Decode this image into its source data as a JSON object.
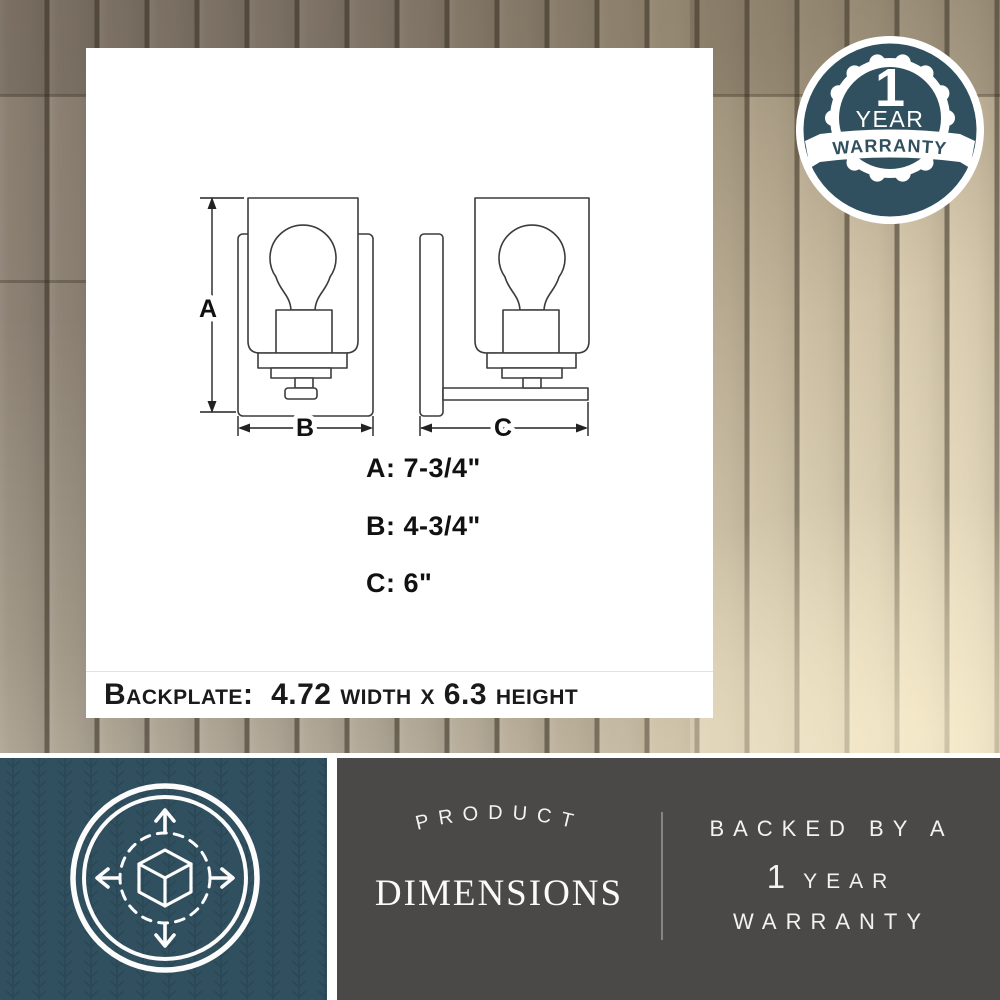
{
  "colors": {
    "teal": "#31505F",
    "teal_pattern": "#24404E",
    "footer_gray": "#4B4947",
    "wall_light": "#DDCFB2",
    "wall_dark": "#8C8173",
    "drawing_line": "#3c3c3c",
    "text_dark": "#1a1a1a",
    "white": "#ffffff"
  },
  "diagram": {
    "markers": [
      "A",
      "B",
      "C"
    ],
    "dim_rows": [
      "A: 7-3/4\"",
      "B: 4-3/4\"",
      "C: 6\""
    ],
    "backplate_note": "Backplate:  4.72 width x 6.3 height"
  },
  "badge": {
    "icon": "warranty-seal-badge",
    "number": "1",
    "year": "YEAR",
    "ribbon": "WARRANTY"
  },
  "footer": {
    "icon": "3d-dimensions-cube-icon",
    "arch": "PRODUCT",
    "title": "DIMENSIONS",
    "line1": "BACKED BY A",
    "line2_number": "1",
    "line2_word": "YEAR",
    "line3": "WARRANTY"
  }
}
